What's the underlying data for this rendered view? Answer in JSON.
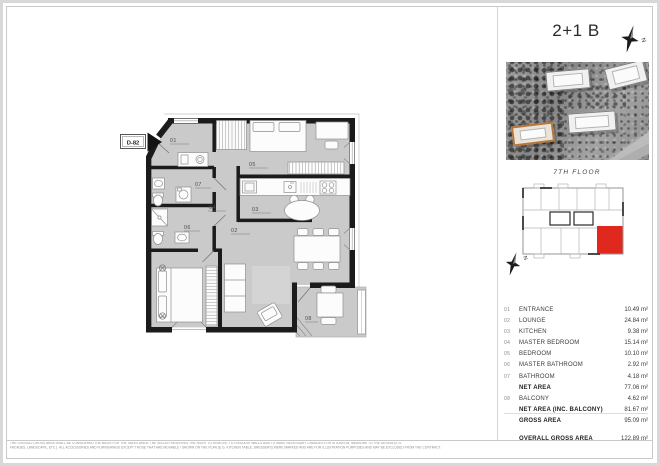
{
  "title_block": {
    "title": "2+1 B"
  },
  "key_plan": {
    "floor_label": "7TH FLOOR",
    "compass_letter": "N"
  },
  "plan": {
    "unit_tag": "D-82",
    "labels": {
      "r01": "01",
      "r02": "02",
      "r03": "03",
      "r04": "04",
      "r05": "05",
      "r06": "06",
      "r07": "07",
      "r08": "08"
    }
  },
  "legend": {
    "rows": [
      {
        "num": "01",
        "label": "ENTRANCE",
        "value": "10.49 m²",
        "bold": false,
        "spaced": false
      },
      {
        "num": "02",
        "label": "LOUNGE",
        "value": "24.84 m²",
        "bold": false,
        "spaced": false
      },
      {
        "num": "03",
        "label": "KITCHEN",
        "value": "9.38 m²",
        "bold": false,
        "spaced": false
      },
      {
        "num": "04",
        "label": "MASTER BEDROOM",
        "value": "15.14 m²",
        "bold": false,
        "spaced": false
      },
      {
        "num": "05",
        "label": "BEDROOM",
        "value": "10.10 m²",
        "bold": false,
        "spaced": false
      },
      {
        "num": "06",
        "label": "MASTER BATHROOM",
        "value": "2.92 m²",
        "bold": false,
        "spaced": false
      },
      {
        "num": "07",
        "label": "BATHROOM",
        "value": "4.18 m²",
        "bold": false,
        "spaced": false
      },
      {
        "num": "",
        "label": "NET AREA",
        "value": "77.06 m²",
        "bold": true,
        "spaced": false
      },
      {
        "num": "08",
        "label": "BALCONY",
        "value": "4.62 m²",
        "bold": false,
        "spaced": false
      },
      {
        "num": "",
        "label": "NET AREA (INC. BALCONY)",
        "value": "81.67 m²",
        "bold": true,
        "spaced": false
      },
      {
        "num": "",
        "label": "GROSS AREA",
        "value": "95.09 m²",
        "bold": true,
        "spaced": false
      },
      {
        "num": "",
        "label": "OVERALL GROSS AREA",
        "value": "122.89 m²",
        "bold": true,
        "spaced": true
      }
    ]
  },
  "footer": {
    "disclaimer_line1": "THE OVERALL GROSS AREA SHALL BE CONSIDERED THE BASIS FOR THE SALES AREA. THE SELLER RESERVES THE RIGHT TO REMOVE, TO DISSOLVE WALLS AND TO MAKE NECESSARY CHANGES FOR SITUATION, MEASURE TO THE DESIGN (E.G.",
    "disclaimer_line2": "FACADES, LANDSCAPE, ETC.). ALL ACCESSORIES AND FURNISHINGS EXCEPT THOSE THAT ARE MOVABLE / SHOWN ON THE PLAN (E.G. KITCHEN TABLE, DRESSERS) WERE MARKED AND ARE FOR ILLUSTRATION PURPOSES AND MAY BE EXCLUDED FROM THE CONTRACT."
  },
  "colors": {
    "accent_red": "#e0281e",
    "highlight_orange": "#b5763c",
    "wall_black": "#1b1b1b",
    "floor_gray": "#cacaca"
  }
}
